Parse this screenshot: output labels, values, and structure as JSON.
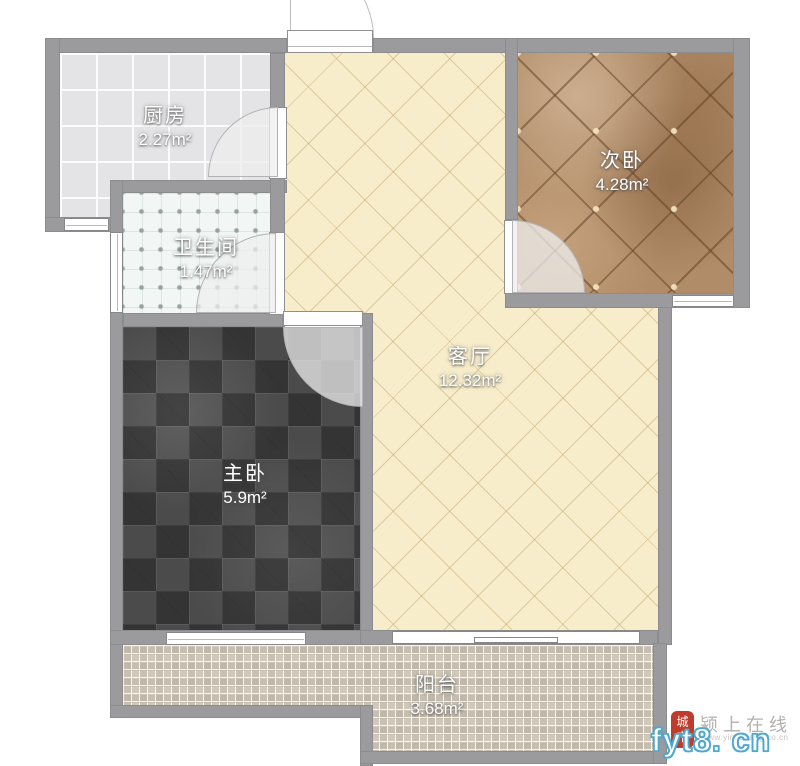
{
  "floorplan": {
    "title": "一室一厅户型图",
    "rooms": [
      {
        "id": "kitchen",
        "name": "厨房",
        "area": "2.27m²"
      },
      {
        "id": "bathroom",
        "name": "卫生间",
        "area": "1.47m²"
      },
      {
        "id": "bedroom2",
        "name": "次卧",
        "area": "4.28m²"
      },
      {
        "id": "living",
        "name": "客厅",
        "area": "12.32m²"
      },
      {
        "id": "master",
        "name": "主卧",
        "area": "5.9m²"
      },
      {
        "id": "balcony",
        "name": "阳台",
        "area": "3.68m²"
      }
    ],
    "colors": {
      "wall": "#9b9b9d",
      "kitchen_floor": "#e4e4e6",
      "bathroom_floor": "#f2f7f5",
      "living_floor": "#f7edca",
      "bedroom2_floor": "#b18c68",
      "master_floor": "#4b4b4b",
      "balcony_floor": "#cfc8bb",
      "door_swing": "#eeeeee"
    }
  },
  "watermark": {
    "seal_text": "城市",
    "site_name": "颍上在线",
    "site_url": "www.yingshang.co.cn",
    "domain": "fyt8. cn",
    "seal_color": "#c13b2c",
    "domain_outline_color": "#4fa8cf"
  }
}
